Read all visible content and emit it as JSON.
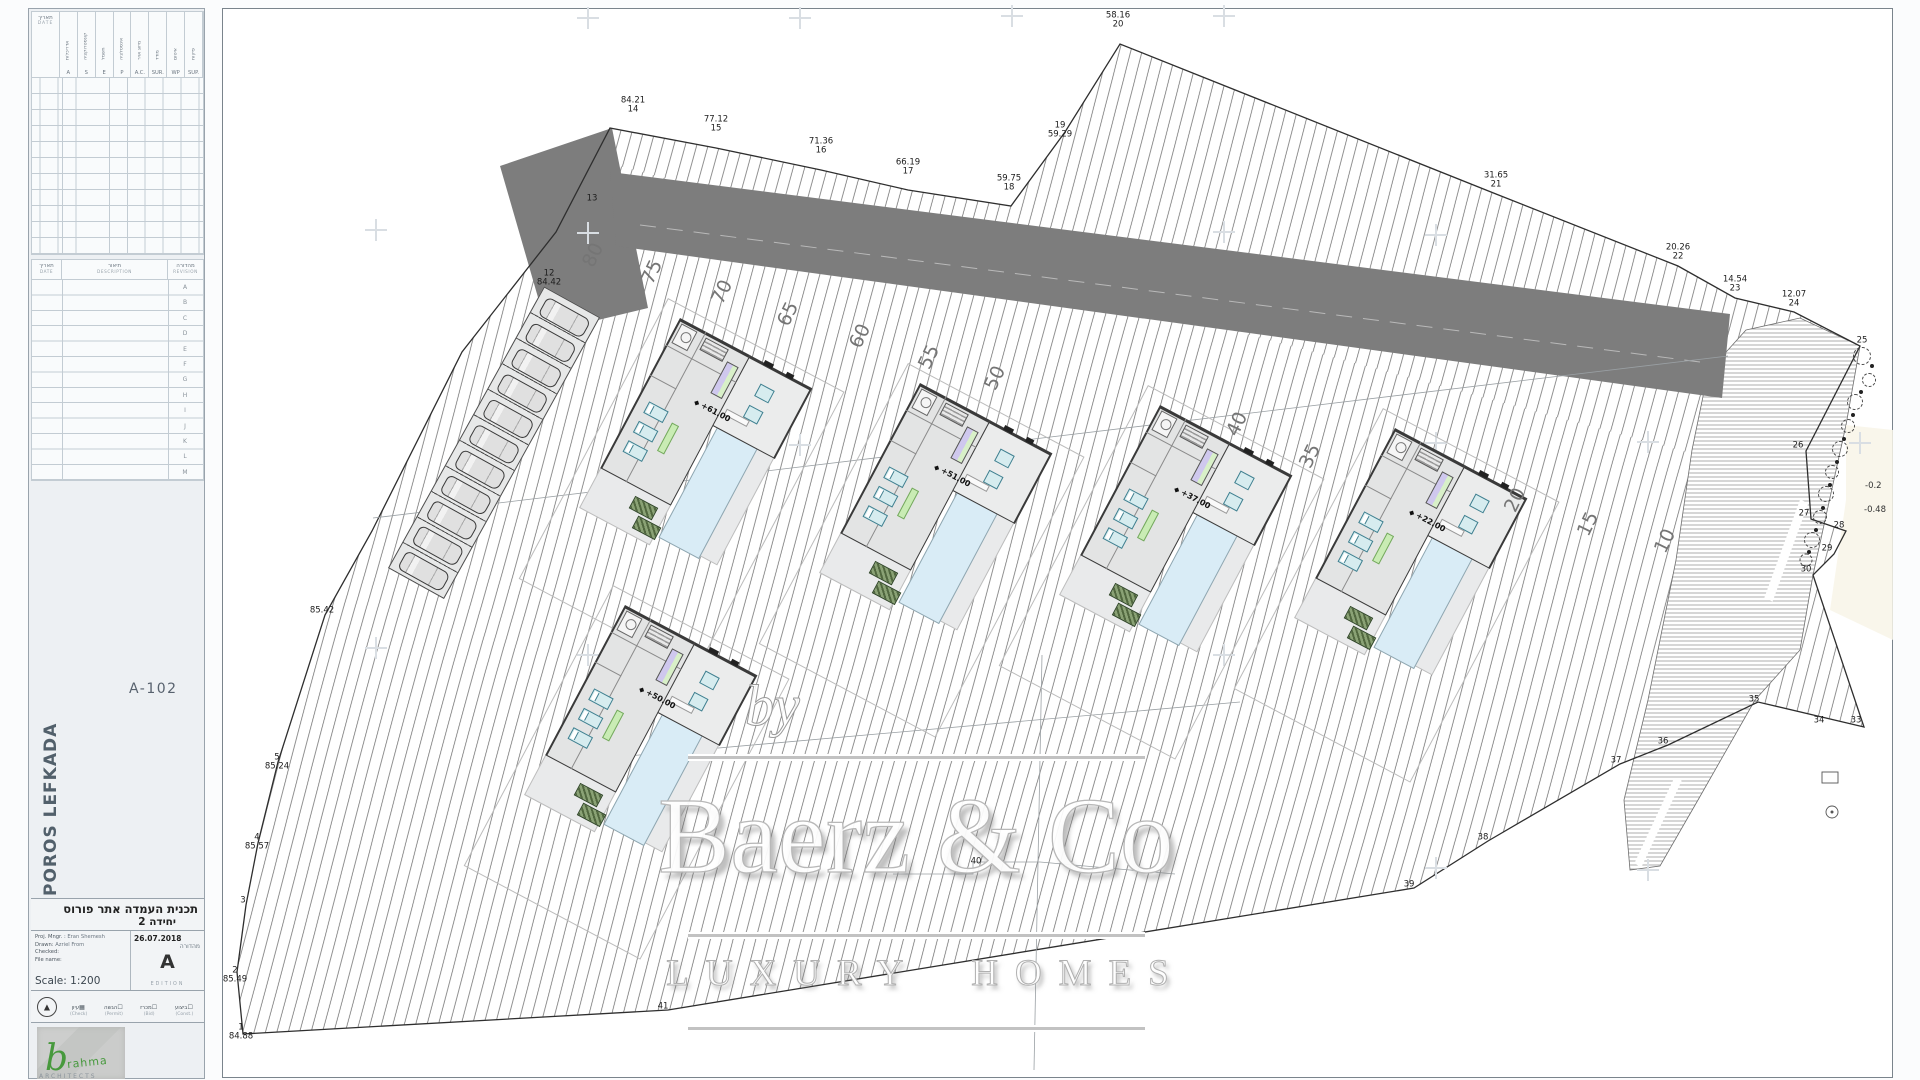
{
  "sidebar": {
    "table1": {
      "date_he": "תאריך",
      "date_en": "DATE",
      "columns": [
        {
          "he": "אדריכלות",
          "ab": "A"
        },
        {
          "he": "קונסטרוקציה",
          "ab": "S"
        },
        {
          "he": "חשמל",
          "ab": "E"
        },
        {
          "he": "אינסטלציה",
          "ab": "P"
        },
        {
          "he": "מיזוג אויר",
          "ab": "A.C."
        },
        {
          "he": "מודד",
          "ab": "SUR."
        },
        {
          "he": "איטום",
          "ab": "WP"
        },
        {
          "he": "פיקוח",
          "ab": "SUP."
        }
      ]
    },
    "table2": {
      "date_he": "תאריך",
      "date_en": "DATE",
      "desc_he": "תיאור",
      "desc_en": "DESCRIPTION",
      "rev_he": "מהדורה",
      "rev_en": "REVISION",
      "rows": [
        {
          "t": "A"
        },
        {
          "t": "B"
        },
        {
          "t": "C"
        },
        {
          "t": "D"
        },
        {
          "t": "E"
        },
        {
          "t": "F"
        },
        {
          "t": "G"
        },
        {
          "t": "H"
        },
        {
          "t": "I"
        },
        {
          "t": "J"
        },
        {
          "t": "K"
        },
        {
          "t": "L"
        },
        {
          "t": "M"
        }
      ]
    },
    "drawing_number": "A-102",
    "project_vertical": "POROS LEFKADA",
    "title_he": "תכנית העמדה אתר פורוס",
    "title_he2": "יחידה 2",
    "info": {
      "mngr_label": "Proj. Mngr. :",
      "mngr": "Eran Shemesh",
      "drawn_label": "Drawn:",
      "drawn": "Azriel From",
      "checked_label": "Checked:",
      "file_label": "File name:",
      "scale_label": "Scale:",
      "scale": "1:200",
      "date": "26.07.2018",
      "edition_he": "מהדורה",
      "edition_letter": "A",
      "edition_en": "EDITION"
    },
    "stamps": [
      {
        "he": "עיון",
        "en": "(Check)",
        "box": "▦"
      },
      {
        "he": "הגשה",
        "en": "(Permit)",
        "box": "☐"
      },
      {
        "he": "מכרז",
        "en": "(Bid)",
        "box": "☐"
      },
      {
        "he": "ביצוע",
        "en": "(Const.)",
        "box": "☐"
      }
    ],
    "logo": {
      "b": "b",
      "rest": "rahma",
      "sub": "ARCHITECTS"
    }
  },
  "plan": {
    "survey_points": [
      {
        "a": "84.21",
        "b": "14",
        "x": 633,
        "y": 115
      },
      {
        "a": "77.12",
        "b": "15",
        "x": 716,
        "y": 134
      },
      {
        "a": "71.36",
        "b": "16",
        "x": 821,
        "y": 156
      },
      {
        "a": "66.19",
        "b": "17",
        "x": 908,
        "y": 177
      },
      {
        "a": "59.75",
        "b": "18",
        "x": 1009,
        "y": 193
      },
      {
        "a": "19",
        "b": "59.29",
        "x": 1060,
        "y": 140
      },
      {
        "a": "58.16",
        "b": "20",
        "x": 1118,
        "y": 30
      },
      {
        "a": "31.65",
        "b": "21",
        "x": 1496,
        "y": 190
      },
      {
        "a": "20.26",
        "b": "22",
        "x": 1678,
        "y": 262
      },
      {
        "a": "14.54",
        "b": "23",
        "x": 1735,
        "y": 294
      },
      {
        "a": "12.07",
        "b": "24",
        "x": 1794,
        "y": 309
      },
      {
        "a": "25",
        "b": "",
        "x": 1862,
        "y": 346
      },
      {
        "a": "26",
        "b": "",
        "x": 1798,
        "y": 451
      },
      {
        "a": "27",
        "b": "",
        "x": 1804,
        "y": 519
      },
      {
        "a": "28",
        "b": "",
        "x": 1839,
        "y": 531
      },
      {
        "a": "29",
        "b": "",
        "x": 1827,
        "y": 554
      },
      {
        "a": "30",
        "b": "",
        "x": 1806,
        "y": 575
      },
      {
        "a": "33",
        "b": "",
        "x": 1856,
        "y": 726
      },
      {
        "a": "34",
        "b": "",
        "x": 1819,
        "y": 726
      },
      {
        "a": "35",
        "b": "",
        "x": 1754,
        "y": 705
      },
      {
        "a": "36",
        "b": "",
        "x": 1663,
        "y": 747
      },
      {
        "a": "37",
        "b": "",
        "x": 1616,
        "y": 766
      },
      {
        "a": "38",
        "b": "",
        "x": 1483,
        "y": 843
      },
      {
        "a": "39",
        "b": "",
        "x": 1409,
        "y": 890
      },
      {
        "a": "40",
        "b": "",
        "x": 976,
        "y": 867
      },
      {
        "a": "41",
        "b": "",
        "x": 663,
        "y": 1012
      },
      {
        "a": "13",
        "b": "",
        "x": 592,
        "y": 204
      },
      {
        "a": "12",
        "b": "84.42",
        "x": 549,
        "y": 288
      },
      {
        "a": "85.42",
        "b": "",
        "x": 322,
        "y": 616
      },
      {
        "a": "5",
        "b": "85.24",
        "x": 277,
        "y": 772
      },
      {
        "a": "4",
        "b": "85.57",
        "x": 257,
        "y": 852
      },
      {
        "a": "3",
        "b": "",
        "x": 243,
        "y": 906
      },
      {
        "a": "2",
        "b": "85.49",
        "x": 235,
        "y": 985
      },
      {
        "a": "1",
        "b": "84.88",
        "x": 241,
        "y": 1042
      }
    ],
    "depth_marks": [
      {
        "t": "-0.2",
        "x": 1865,
        "y": 481
      },
      {
        "t": "-0.48",
        "x": 1864,
        "y": 505
      }
    ],
    "contour_labels": [
      {
        "t": "80",
        "x": 593,
        "y": 255
      },
      {
        "t": "75",
        "x": 652,
        "y": 272
      },
      {
        "t": "70",
        "x": 722,
        "y": 292
      },
      {
        "t": "65",
        "x": 788,
        "y": 314
      },
      {
        "t": "60",
        "x": 860,
        "y": 336
      },
      {
        "t": "55",
        "x": 929,
        "y": 357
      },
      {
        "t": "50",
        "x": 995,
        "y": 378
      },
      {
        "t": "40",
        "x": 1237,
        "y": 424
      },
      {
        "t": "35",
        "x": 1310,
        "y": 456
      },
      {
        "t": "20",
        "x": 1515,
        "y": 500
      },
      {
        "t": "15",
        "x": 1588,
        "y": 524
      },
      {
        "t": "10",
        "x": 1665,
        "y": 541
      }
    ],
    "villas": [
      {
        "elev": "+61.00"
      },
      {
        "elev": "+51.00"
      },
      {
        "elev": "+37.00"
      },
      {
        "elev": "+22.00"
      },
      {
        "elev": "+50.00"
      }
    ],
    "parking": {
      "stalls": [
        {
          "x": 3,
          "y": 7
        },
        {
          "x": 32,
          "y": 7
        },
        {
          "x": 61,
          "y": 7
        },
        {
          "x": 90,
          "y": 7
        },
        {
          "x": 119,
          "y": 7
        },
        {
          "x": 148,
          "y": 7
        },
        {
          "x": 177,
          "y": 7
        },
        {
          "x": 206,
          "y": 7
        },
        {
          "x": 235,
          "y": 7
        },
        {
          "x": 264,
          "y": 7
        },
        {
          "x": 293,
          "y": 7
        }
      ]
    },
    "trees": [
      {
        "x": 1862,
        "y": 356,
        "w": 18,
        "h": 18
      },
      {
        "x": 1869,
        "y": 380,
        "w": 14,
        "h": 14
      },
      {
        "x": 1855,
        "y": 402,
        "w": 16,
        "h": 16
      },
      {
        "x": 1848,
        "y": 426,
        "w": 14,
        "h": 14
      },
      {
        "x": 1840,
        "y": 449,
        "w": 16,
        "h": 16
      },
      {
        "x": 1832,
        "y": 472,
        "w": 14,
        "h": 14
      },
      {
        "x": 1826,
        "y": 494,
        "w": 16,
        "h": 16
      },
      {
        "x": 1820,
        "y": 517,
        "w": 14,
        "h": 14
      },
      {
        "x": 1812,
        "y": 540,
        "w": 16,
        "h": 16
      },
      {
        "x": 1806,
        "y": 560,
        "w": 13,
        "h": 13
      }
    ],
    "tree_dots": [
      {
        "x": 1872,
        "y": 366
      },
      {
        "x": 1861,
        "y": 392
      },
      {
        "x": 1853,
        "y": 415
      },
      {
        "x": 1844,
        "y": 439
      },
      {
        "x": 1837,
        "y": 462
      },
      {
        "x": 1830,
        "y": 485
      },
      {
        "x": 1823,
        "y": 508
      },
      {
        "x": 1816,
        "y": 530
      },
      {
        "x": 1809,
        "y": 552
      }
    ],
    "crosses": [
      {
        "x": 588,
        "y": 18
      },
      {
        "x": 800,
        "y": 18
      },
      {
        "x": 1012,
        "y": 16
      },
      {
        "x": 1224,
        "y": 16
      },
      {
        "x": 376,
        "y": 230
      },
      {
        "x": 588,
        "y": 233
      },
      {
        "x": 1224,
        "y": 232
      },
      {
        "x": 1436,
        "y": 235
      },
      {
        "x": 800,
        "y": 445
      },
      {
        "x": 1436,
        "y": 443
      },
      {
        "x": 1648,
        "y": 442
      },
      {
        "x": 1860,
        "y": 443
      },
      {
        "x": 376,
        "y": 648
      },
      {
        "x": 588,
        "y": 655
      },
      {
        "x": 1224,
        "y": 655
      },
      {
        "x": 1436,
        "y": 868
      },
      {
        "x": 1648,
        "y": 870
      }
    ],
    "watermark": {
      "by": "by",
      "name": "Baerz & Co",
      "tagline": "LUXURY HOMES"
    }
  }
}
